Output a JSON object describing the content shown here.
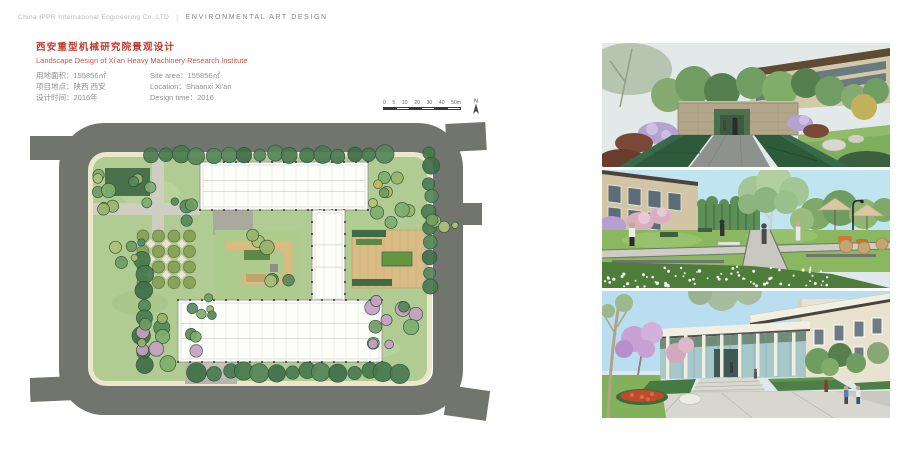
{
  "header": {
    "company": "China IPPR International Engineering Co.,LTD",
    "divider": "|",
    "department": "ENVIRONMENTAL ART DESIGN"
  },
  "title_block": {
    "title_zh": "西安重型机械研究院景观设计",
    "title_en": "Landscape Design of Xi'an Heavy Machinery Research Institute",
    "accent_color": "#c0392b",
    "fields": [
      {
        "zh": "用地面积：155856㎡",
        "en": "Site area：155856㎡"
      },
      {
        "zh": "项目地点：陕西 西安",
        "en": "Location：Shaanxi Xi'an"
      },
      {
        "zh": "设计时间：2016年",
        "en": "Design time：2016"
      }
    ]
  },
  "scale_bar": {
    "labels": [
      "0",
      "5",
      "10",
      "20",
      "30",
      "40",
      "50m"
    ],
    "north_label": "N"
  },
  "colors": {
    "road": "#71756e",
    "sidewalk": "#ece6cb",
    "lawn": "#b0cc93",
    "building": "#fdfdfa",
    "deck": "#d9bc85",
    "accent_red": "#c0392b",
    "text_gray": "#8f8f8d"
  },
  "plan": {
    "buildings": [
      {
        "x": 170,
        "y": 64,
        "w": 168,
        "h": 48
      },
      {
        "x": 282,
        "y": 112,
        "w": 33,
        "h": 92
      },
      {
        "x": 148,
        "y": 202,
        "w": 204,
        "h": 62
      }
    ],
    "plaza": {
      "x": 113,
      "y": 138,
      "cols": 4,
      "rows": 4,
      "step": 15.5,
      "tree_r": 6,
      "tree_fill": "#8aa35a",
      "pad_fill": "#d8d4bc"
    },
    "palettes": {
      "dark": [
        "#3f6e48",
        "#4a7b50",
        "#55875a",
        "#477a4e"
      ],
      "mixed": [
        "#6f9c63",
        "#7fae6e",
        "#9ab46a",
        "#57895a",
        "#aec177"
      ],
      "mixedPink": [
        "#6f9c63",
        "#7fae6e",
        "#c79fc3",
        "#57895a",
        "#9ab46a",
        "#c79fc3"
      ],
      "mixedYellow": [
        "#9ab46a",
        "#b9c46d",
        "#c9b45c",
        "#7fae6e",
        "#6f9c63"
      ]
    },
    "tree_rows": [
      {
        "x1": 120,
        "y1": 57,
        "x2": 355,
        "y2": 57,
        "n": 16,
        "r": 7.5,
        "palette": "dark"
      },
      {
        "x1": 113,
        "y1": 160,
        "x2": 113,
        "y2": 268,
        "n": 8,
        "r": 7.5,
        "palette": "dark"
      },
      {
        "x1": 400,
        "y1": 54,
        "x2": 400,
        "y2": 190,
        "n": 10,
        "r": 7,
        "palette": "dark"
      },
      {
        "x1": 168,
        "y1": 274,
        "x2": 370,
        "y2": 274,
        "n": 14,
        "r": 8,
        "palette": "dark"
      }
    ],
    "tree_clusters": [
      {
        "cx": 88,
        "cy": 92,
        "n": 11,
        "spread": 34,
        "r": 6,
        "palette": "mixed"
      },
      {
        "cx": 95,
        "cy": 150,
        "n": 5,
        "spread": 18,
        "r": 5,
        "palette": "mixed"
      },
      {
        "cx": 135,
        "cy": 238,
        "n": 12,
        "spread": 36,
        "r": 6.5,
        "palette": "mixedPink"
      },
      {
        "cx": 172,
        "cy": 212,
        "n": 5,
        "spread": 16,
        "r": 5,
        "palette": "mixed"
      },
      {
        "cx": 365,
        "cy": 100,
        "n": 10,
        "spread": 30,
        "r": 6,
        "palette": "mixedYellow"
      },
      {
        "cx": 362,
        "cy": 225,
        "n": 11,
        "spread": 33,
        "r": 6.5,
        "palette": "mixedPink"
      },
      {
        "cx": 152,
        "cy": 112,
        "n": 4,
        "spread": 14,
        "r": 5.5,
        "palette": "mixed"
      },
      {
        "cx": 228,
        "cy": 146,
        "n": 3,
        "spread": 12,
        "r": 6,
        "palette": "mixed"
      },
      {
        "cx": 250,
        "cy": 185,
        "n": 3,
        "spread": 12,
        "r": 6,
        "palette": "mixed"
      },
      {
        "cx": 412,
        "cy": 130,
        "n": 4,
        "spread": 14,
        "r": 5,
        "palette": "mixed"
      }
    ]
  },
  "renders": {
    "flower_dots": {
      "count": 70,
      "x": 2,
      "y": 96,
      "w": 226,
      "h": 21
    }
  }
}
